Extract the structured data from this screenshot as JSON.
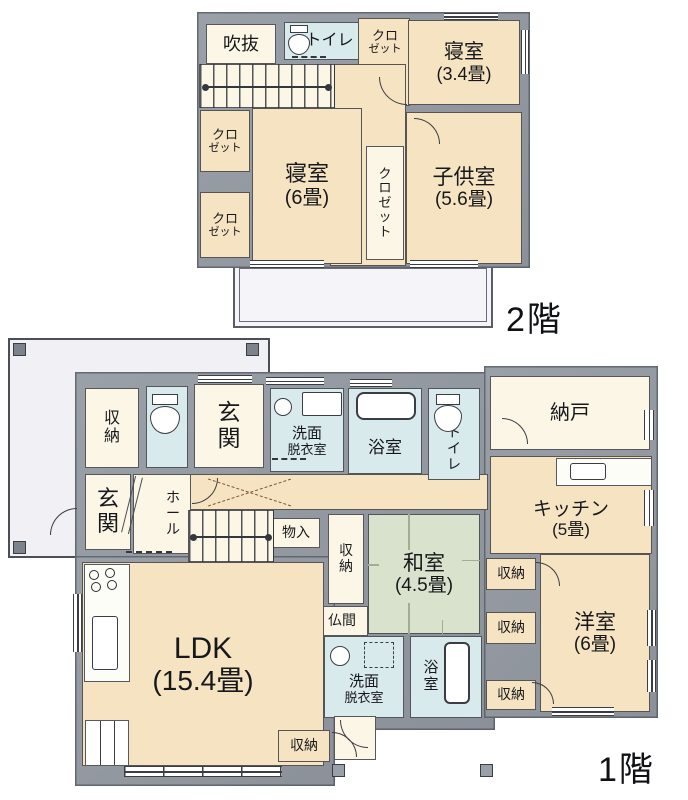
{
  "plan_title_labels": {
    "floor2": "2階",
    "floor1": "1階"
  },
  "colors": {
    "wall": "#959aa4",
    "outline": "#34373e",
    "cream": "#f6e3c1",
    "pale": "#fbf6e6",
    "blue": "#d9eaec",
    "tatami": "#d9e2cc",
    "white": "#ffffff",
    "balcony": "#f5f5f9",
    "garage": "#f1f1f5",
    "text": "#17181c"
  },
  "floor2": {
    "label": "2階",
    "walls": [
      {
        "x": 197,
        "y": 12,
        "w": 333,
        "h": 256
      }
    ],
    "rooms": [
      {
        "n": "hall-upper-2f",
        "f": "cream",
        "x": 358,
        "y": 18,
        "w": 52,
        "h": 88
      },
      {
        "n": "hall-2f",
        "f": "cream",
        "x": 330,
        "y": 64,
        "w": 76,
        "h": 202
      },
      {
        "n": "void-fukinuke",
        "l": "吹抜",
        "f": "pale",
        "x": 206,
        "y": 24,
        "w": 70,
        "h": 40,
        "fs": 18
      },
      {
        "n": "toilet-2f",
        "l": "トイレ",
        "f": "blue",
        "x": 284,
        "y": 22,
        "w": 75,
        "h": 38,
        "fs": 16,
        "pl": 16
      },
      {
        "n": "closet-2f-top",
        "l": "クロ",
        "s": "ゼット",
        "f": "none",
        "x": 360,
        "y": 20,
        "w": 50,
        "h": 44,
        "fs": 13
      },
      {
        "n": "bedroom-3-4",
        "l": "寝室",
        "s": "(3.4畳)",
        "f": "cream",
        "x": 408,
        "y": 20,
        "w": 112,
        "h": 85,
        "fs": 20
      },
      {
        "n": "closet-2f-upper-left",
        "l": "クロ",
        "s": "ゼット",
        "f": "cream",
        "x": 200,
        "y": 110,
        "w": 50,
        "h": 62,
        "fs": 13
      },
      {
        "n": "closet-2f-lower-left",
        "l": "クロ",
        "s": "ゼット",
        "f": "cream",
        "x": 200,
        "y": 192,
        "w": 50,
        "h": 66,
        "fs": 13
      },
      {
        "n": "bedroom-6",
        "l": "寝室",
        "s": "(6畳)",
        "f": "cream",
        "x": 252,
        "y": 108,
        "w": 110,
        "h": 156,
        "fs": 22
      },
      {
        "n": "closet-2f-center",
        "l": "クロゼット",
        "v": 1,
        "f": "pale",
        "x": 366,
        "y": 146,
        "w": 38,
        "h": 114,
        "fs": 13
      },
      {
        "n": "kids-room",
        "l": "子供室",
        "s": "(5.6畳)",
        "f": "cream",
        "x": 406,
        "y": 112,
        "w": 116,
        "h": 152,
        "fs": 21
      }
    ],
    "stairs": [
      {
        "x": 199,
        "y": 64,
        "w": 136,
        "h": 44
      }
    ],
    "windows": [
      {
        "x": 444,
        "y": 13,
        "w": 54,
        "h": 7,
        "o": "h"
      },
      {
        "x": 521,
        "y": 30,
        "w": 8,
        "h": 44,
        "o": "v"
      },
      {
        "x": 250,
        "y": 260,
        "w": 74,
        "h": 8,
        "o": "h"
      },
      {
        "x": 410,
        "y": 260,
        "w": 68,
        "h": 8,
        "o": "h"
      }
    ],
    "arcs": [
      {
        "x": 379,
        "y": 77,
        "r": 28,
        "c": "bl"
      },
      {
        "x": 414,
        "y": 118,
        "r": 26,
        "c": "tr"
      }
    ],
    "icons": [
      {
        "t": "toilet",
        "x": 288,
        "y": 25,
        "w": 22,
        "h": 30
      },
      {
        "t": "dash",
        "x": 292,
        "y": 56,
        "w": 34,
        "h": 3
      }
    ],
    "balcony": {
      "x": 233,
      "y": 262,
      "w": 260,
      "h": 66
    }
  },
  "floor1": {
    "label": "1階",
    "garage": {
      "x": 8,
      "y": 338,
      "w": 262,
      "h": 220,
      "squares": [
        [
          13,
          343
        ],
        [
          246,
          343
        ],
        [
          13,
          541
        ]
      ]
    },
    "walls": [
      {
        "x": 75,
        "y": 372,
        "w": 420,
        "h": 358
      },
      {
        "x": 484,
        "y": 366,
        "w": 174,
        "h": 352
      },
      {
        "x": 75,
        "y": 556,
        "w": 260,
        "h": 230
      }
    ],
    "rooms": [
      {
        "n": "corridor",
        "f": "cream",
        "x": 190,
        "y": 474,
        "w": 298,
        "h": 36
      },
      {
        "n": "storage-top-left",
        "l": "収納",
        "v": 1,
        "f": "pale",
        "x": 85,
        "y": 388,
        "w": 54,
        "h": 80,
        "fs": 16
      },
      {
        "n": "toilet-1f-left",
        "f": "blue",
        "x": 146,
        "y": 386,
        "w": 42,
        "h": 82
      },
      {
        "n": "entrance-top",
        "l": "玄関",
        "v": 1,
        "f": "pale",
        "x": 194,
        "y": 384,
        "w": 70,
        "h": 84,
        "fs": 23
      },
      {
        "n": "washroom-top",
        "l": "洗面",
        "s": "脱衣室",
        "f": "blue",
        "x": 270,
        "y": 388,
        "w": 74,
        "h": 84,
        "fs": 15,
        "pt": 24
      },
      {
        "n": "bathroom-top",
        "l": "浴室",
        "f": "blue",
        "x": 348,
        "y": 388,
        "w": 74,
        "h": 86,
        "fs": 17,
        "pt": 34
      },
      {
        "n": "toilet-1f-right",
        "l": "トイレ",
        "v": 1,
        "f": "blue",
        "x": 428,
        "y": 388,
        "w": 52,
        "h": 92,
        "fs": 14,
        "pt": 30
      },
      {
        "n": "storeroom-nando",
        "l": "納戸",
        "f": "pale",
        "x": 490,
        "y": 376,
        "w": 160,
        "h": 74,
        "fs": 20
      },
      {
        "n": "kitchen",
        "l": "キッチン",
        "s": "(5畳)",
        "f": "cream",
        "x": 490,
        "y": 456,
        "w": 162,
        "h": 98,
        "fs": 19,
        "pt": 28
      },
      {
        "n": "entrance-left",
        "l": "玄関",
        "v": 1,
        "f": "pale",
        "x": 85,
        "y": 474,
        "w": 46,
        "h": 76,
        "fs": 22
      },
      {
        "n": "hall-1f",
        "l": "ホール",
        "v": 1,
        "f": "pale",
        "x": 133,
        "y": 474,
        "w": 58,
        "h": 80,
        "fs": 14,
        "pl": 22
      },
      {
        "n": "storage-mono-ire",
        "l": "物入",
        "f": "pale",
        "x": 272,
        "y": 518,
        "w": 48,
        "h": 30,
        "fs": 14
      },
      {
        "n": "storage-center",
        "l": "収納",
        "v": 1,
        "f": "pale",
        "x": 328,
        "y": 514,
        "w": 36,
        "h": 90,
        "fs": 14
      },
      {
        "n": "washitsu",
        "l": "和室",
        "s": "(4.5畳)",
        "f": "tatami",
        "x": 368,
        "y": 514,
        "w": 112,
        "h": 120,
        "fs": 21
      },
      {
        "n": "butsuma",
        "l": "仏間",
        "f": "pale",
        "x": 316,
        "y": 606,
        "w": 52,
        "h": 30,
        "fs": 14
      },
      {
        "n": "ldk",
        "l": "LDK",
        "s": "(15.4畳)",
        "f": "cream",
        "x": 82,
        "y": 562,
        "w": 242,
        "h": 204,
        "fs": 30
      },
      {
        "n": "storage-ldk",
        "l": "収納",
        "f": "cream",
        "x": 278,
        "y": 730,
        "w": 52,
        "h": 32,
        "fs": 14
      },
      {
        "n": "washroom-bottom",
        "l": "洗面",
        "s": "脱衣室",
        "f": "blue",
        "x": 324,
        "y": 636,
        "w": 80,
        "h": 82,
        "fs": 15,
        "pt": 26
      },
      {
        "n": "bathroom-bottom",
        "l": "浴室",
        "v": 1,
        "f": "blue",
        "x": 410,
        "y": 636,
        "w": 72,
        "h": 82,
        "fs": 15,
        "pr": 30
      },
      {
        "n": "storage-right-1",
        "l": "収納",
        "f": "cream",
        "x": 486,
        "y": 558,
        "w": 50,
        "h": 32,
        "fs": 14
      },
      {
        "n": "storage-right-2",
        "l": "収納",
        "f": "cream",
        "x": 486,
        "y": 612,
        "w": 50,
        "h": 32,
        "fs": 14
      },
      {
        "n": "storage-right-3",
        "l": "収納",
        "f": "cream",
        "x": 486,
        "y": 680,
        "w": 50,
        "h": 30,
        "fs": 14
      },
      {
        "n": "western-room",
        "l": "洋室",
        "s": "(6畳)",
        "f": "cream",
        "x": 540,
        "y": 554,
        "w": 110,
        "h": 158,
        "fs": 21
      },
      {
        "n": "back-porch",
        "f": "pale",
        "x": 334,
        "y": 716,
        "w": 42,
        "h": 44
      }
    ],
    "stairs": [
      {
        "x": 188,
        "y": 510,
        "w": 86,
        "h": 52
      }
    ],
    "windows": [
      {
        "x": 198,
        "y": 375,
        "w": 54,
        "h": 8,
        "o": "h"
      },
      {
        "x": 266,
        "y": 377,
        "w": 58,
        "h": 8,
        "o": "h"
      },
      {
        "x": 350,
        "y": 379,
        "w": 42,
        "h": 8,
        "o": "h"
      },
      {
        "x": 644,
        "y": 410,
        "w": 10,
        "h": 30,
        "o": "v"
      },
      {
        "x": 644,
        "y": 490,
        "w": 10,
        "h": 36,
        "o": "v"
      },
      {
        "x": 647,
        "y": 610,
        "w": 9,
        "h": 36,
        "o": "v"
      },
      {
        "x": 647,
        "y": 660,
        "w": 9,
        "h": 32,
        "o": "v"
      },
      {
        "x": 552,
        "y": 707,
        "w": 62,
        "h": 9,
        "o": "h"
      },
      {
        "x": 124,
        "y": 766,
        "w": 158,
        "h": 11,
        "o": "h",
        "m": 1
      },
      {
        "x": 73,
        "y": 594,
        "w": 9,
        "h": 58,
        "o": "v"
      }
    ],
    "arcs": [
      {
        "x": 50,
        "y": 508,
        "r": 27,
        "c": "tl"
      },
      {
        "x": 502,
        "y": 418,
        "r": 26,
        "c": "tr"
      },
      {
        "x": 536,
        "y": 562,
        "r": 24,
        "c": "tr"
      },
      {
        "x": 532,
        "y": 682,
        "r": 22,
        "c": "tr"
      },
      {
        "x": 332,
        "y": 732,
        "r": 25,
        "c": "tr"
      },
      {
        "x": 340,
        "y": 720,
        "r": 28,
        "c": "bl"
      },
      {
        "x": 192,
        "y": 478,
        "r": 26,
        "c": "br"
      }
    ],
    "icons": [
      {
        "t": "toilet",
        "x": 150,
        "y": 394,
        "w": 30,
        "h": 40
      },
      {
        "t": "toilet",
        "x": 434,
        "y": 394,
        "w": 28,
        "h": 38
      },
      {
        "t": "tub",
        "x": 356,
        "y": 392,
        "w": 60,
        "h": 28
      },
      {
        "t": "sink-circle",
        "x": 274,
        "y": 398,
        "w": 18,
        "h": 18
      },
      {
        "t": "rect",
        "x": 302,
        "y": 392,
        "w": 40,
        "h": 24
      },
      {
        "t": "dash",
        "x": 272,
        "y": 458,
        "w": 34,
        "h": 3
      },
      {
        "t": "counter",
        "x": 556,
        "y": 458,
        "w": 96,
        "h": 28
      },
      {
        "t": "sink-rect",
        "x": 570,
        "y": 463,
        "w": 36,
        "h": 17
      },
      {
        "t": "counter",
        "x": 84,
        "y": 564,
        "w": 46,
        "h": 118
      },
      {
        "t": "stove",
        "x": 88,
        "y": 568,
        "w": 34,
        "h": 26
      },
      {
        "t": "sink-rect",
        "x": 92,
        "y": 616,
        "w": 26,
        "h": 54
      },
      {
        "t": "sink-circle",
        "x": 330,
        "y": 646,
        "w": 20,
        "h": 20
      },
      {
        "t": "dash-rect",
        "x": 364,
        "y": 642,
        "w": 30,
        "h": 26
      },
      {
        "t": "tub-v",
        "x": 444,
        "y": 642,
        "w": 26,
        "h": 62
      },
      {
        "t": "vlines",
        "x": 85,
        "y": 720,
        "w": 44,
        "h": 46
      },
      {
        "t": "xcross",
        "x": 208,
        "y": 478,
        "w": 84,
        "h": 30
      },
      {
        "t": "step",
        "x": 124,
        "y": 476,
        "w": 14,
        "h": 58
      },
      {
        "t": "dash",
        "x": 126,
        "y": 551,
        "w": 46,
        "h": 3
      },
      {
        "t": "tatami",
        "x": 368,
        "y": 514,
        "w": 112,
        "h": 120
      },
      {
        "t": "sq",
        "x": 332,
        "y": 764,
        "w": 13,
        "h": 13
      },
      {
        "t": "sq",
        "x": 480,
        "y": 764,
        "w": 13,
        "h": 13
      }
    ]
  }
}
